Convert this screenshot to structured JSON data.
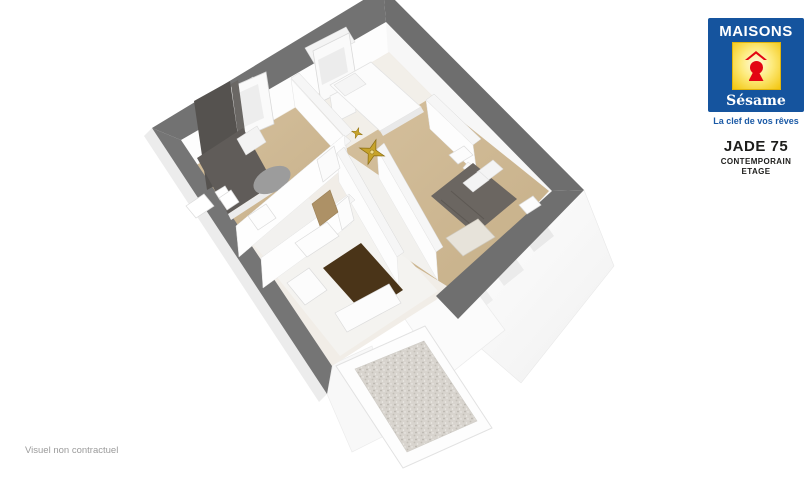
{
  "page": {
    "background": "#ffffff"
  },
  "brand": {
    "name_top": "MAISONS",
    "name_bottom": "Sésame",
    "tagline": "La clef de vos rêves",
    "colors": {
      "blue": "#15549e",
      "yellow": "#f3c50d",
      "red": "#e30613",
      "white": "#ffffff"
    }
  },
  "model": {
    "name": "JADE 75",
    "style": "CONTEMPORAIN",
    "level": "ETAGE",
    "text_color": "#1d1d1b"
  },
  "disclaimer": {
    "text": "Visuel non contractuel",
    "color": "#9b9b9b"
  },
  "floor_plan": {
    "description": "3D axonometric view of the upper floor: three bedrooms, bathroom, landing with corridor, gravel terrace",
    "colors": {
      "exterior_wall_top": "#717171",
      "interior_wall": "#fbfbfb",
      "wood_floor": "#cdb894",
      "light_floor": "#f2f0eb",
      "dark_furniture": "#5f5b58",
      "bed_brown_gray": "#6b6661",
      "rug_brown": "#4a3418",
      "gravel": "#d8d4ce",
      "compass_gold": "#c7a32b"
    },
    "icons": [
      "compass-rose",
      "double-bed",
      "single-bed",
      "curtain-window",
      "rug",
      "terrace-gravel",
      "toilet",
      "door-leaf"
    ]
  }
}
